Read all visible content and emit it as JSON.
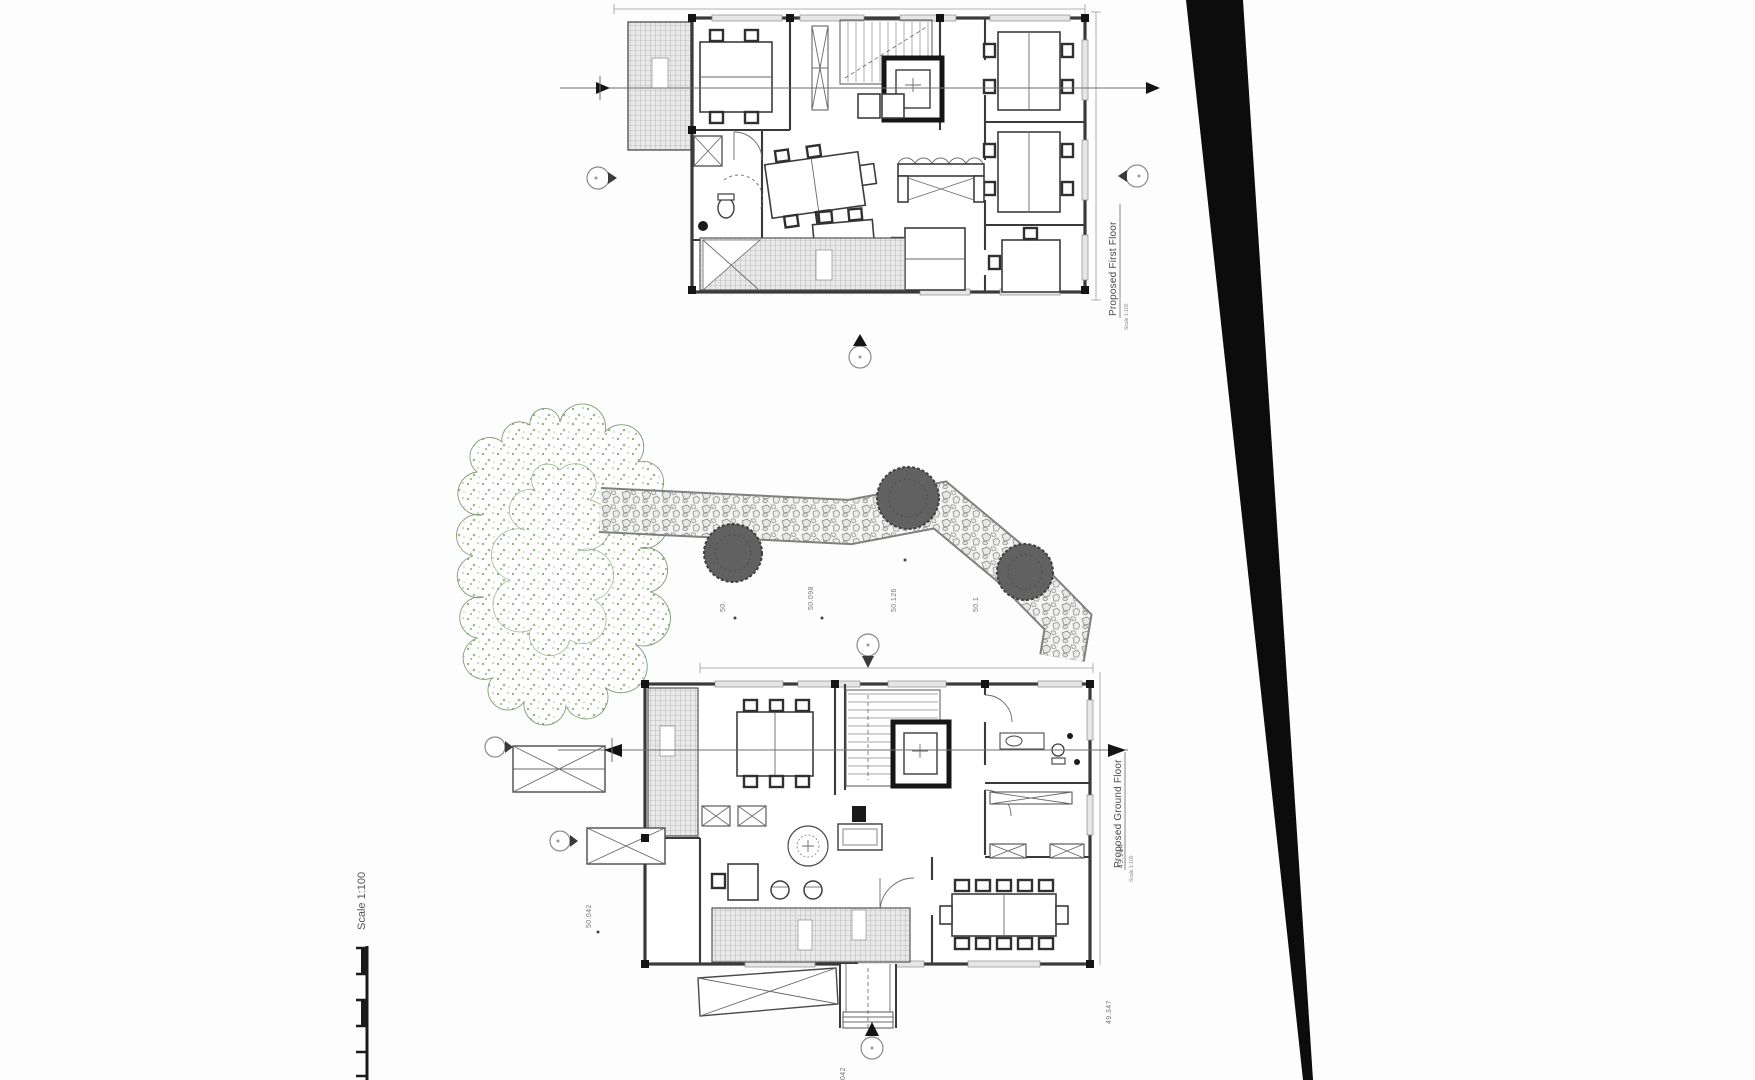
{
  "drawing": {
    "titles": {
      "first_floor": "Proposed First Floor",
      "ground_floor": "Proposed Ground Floor",
      "scale_note": "Scale 1:100"
    },
    "scale_bar_label": "Scale 1:100",
    "levels": [
      {
        "value": "50."
      },
      {
        "value": "50.098"
      },
      {
        "value": "50.126"
      },
      {
        "value": "50.1"
      },
      {
        "value": "50.042"
      },
      {
        "value": "49.144"
      },
      {
        "value": "49.347"
      },
      {
        "value": "042"
      }
    ],
    "colors": {
      "wall": "#3a3a3a",
      "line": "#6b6b6b",
      "hatch": "#9e9e9e",
      "tree": "#7d9f70",
      "bush": "#5f5f5f",
      "edge": "#0c0c0c",
      "text": "#555555",
      "paper": "#fdfdfd"
    }
  }
}
